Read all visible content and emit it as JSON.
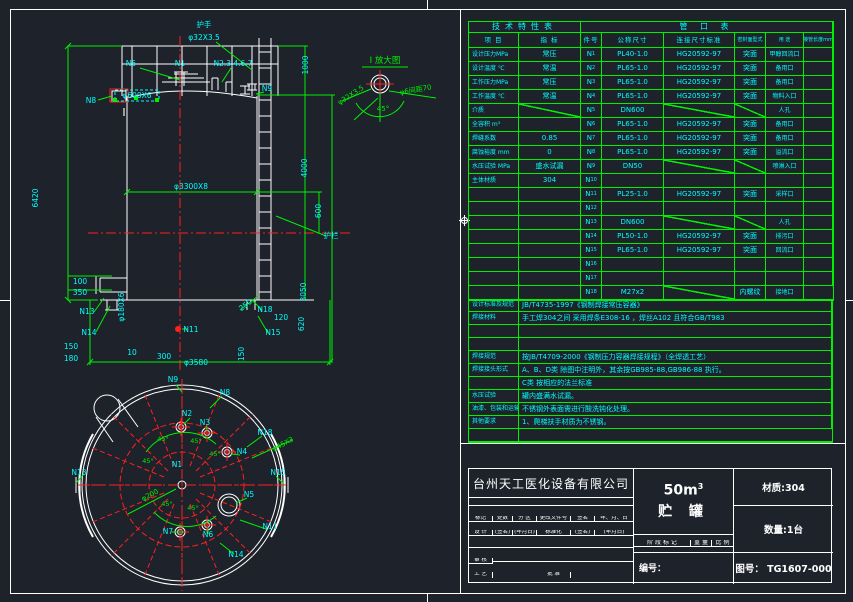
{
  "tech_table": {
    "title": "技术特性表",
    "headers": [
      "项 目",
      "指 标"
    ],
    "rows": [
      {
        "label": "设计压力MPa",
        "value": "常压"
      },
      {
        "label": "设计温度 ℃",
        "value": "常温"
      },
      {
        "label": "工作压力MPa",
        "value": "常压"
      },
      {
        "label": "工作温度 ℃",
        "value": "常温"
      },
      {
        "label": "介质",
        "value": "",
        "vd": true
      },
      {
        "label": "全容积  m³",
        "value": ""
      },
      {
        "label": "焊缝系数",
        "value": "0.85"
      },
      {
        "label": "腐蚀裕度 mm",
        "value": "0"
      },
      {
        "label": "水压试验 MPa",
        "value": "盛水试漏"
      },
      {
        "label": "主体材质",
        "value": "304"
      },
      {
        "label": "",
        "value": ""
      },
      {
        "label": "",
        "value": ""
      },
      {
        "label": "",
        "value": ""
      },
      {
        "label": "",
        "value": ""
      },
      {
        "label": "",
        "value": ""
      },
      {
        "label": "",
        "value": ""
      },
      {
        "label": "",
        "value": ""
      },
      {
        "label": "",
        "value": ""
      }
    ]
  },
  "nozzle_table": {
    "title": "管 口 表",
    "headers": [
      "件号",
      "公称尺寸",
      "连接尺寸标准",
      "密封面型式",
      "用 途",
      "接管长度mm"
    ],
    "rows": [
      {
        "no": "N1",
        "size": "PL40-1.0",
        "std": "HG20592-97",
        "face": "突面",
        "use": "甲醇回流口",
        "len": ""
      },
      {
        "no": "N2",
        "size": "PL65-1.0",
        "std": "HG20592-97",
        "face": "突面",
        "use": "备用口",
        "len": ""
      },
      {
        "no": "N3",
        "size": "PL65-1.0",
        "std": "HG20592-97",
        "face": "突面",
        "use": "备用口",
        "len": ""
      },
      {
        "no": "N4",
        "size": "PL65-1.0",
        "std": "HG20592-97",
        "face": "突面",
        "use": "物料入口",
        "len": ""
      },
      {
        "no": "N5",
        "size": "DN600",
        "std": "",
        "face": "",
        "use": "人孔",
        "len": "",
        "sd": true,
        "fd": true
      },
      {
        "no": "N6",
        "size": "PL65-1.0",
        "std": "HG20592-97",
        "face": "突面",
        "use": "备用口",
        "len": ""
      },
      {
        "no": "N7",
        "size": "PL65-1.0",
        "std": "HG20592-97",
        "face": "突面",
        "use": "备用口",
        "len": ""
      },
      {
        "no": "N8",
        "size": "PL65-1.0",
        "std": "HG20592-97",
        "face": "突面",
        "use": "溢流口",
        "len": ""
      },
      {
        "no": "N9",
        "size": "DN50",
        "std": "",
        "face": "",
        "use": "喷淋入口",
        "len": "",
        "sd": true,
        "fd": true
      },
      {
        "no": "N10",
        "size": "",
        "std": "",
        "face": "",
        "use": "",
        "len": ""
      },
      {
        "no": "N11",
        "size": "PL25-1.0",
        "std": "HG20592-97",
        "face": "突面",
        "use": "采样口",
        "len": ""
      },
      {
        "no": "N12",
        "size": "",
        "std": "",
        "face": "",
        "use": "",
        "len": ""
      },
      {
        "no": "N13",
        "size": "DN600",
        "std": "",
        "face": "",
        "use": "人孔",
        "len": "",
        "sd": true,
        "fd": true
      },
      {
        "no": "N14",
        "size": "PL50-1.0",
        "std": "HG20592-97",
        "face": "突面",
        "use": "排污口",
        "len": ""
      },
      {
        "no": "N15",
        "size": "PL65-1.0",
        "std": "HG20592-97",
        "face": "突面",
        "use": "回流口",
        "len": ""
      },
      {
        "no": "N16",
        "size": "",
        "std": "",
        "face": "",
        "use": "",
        "len": ""
      },
      {
        "no": "N17",
        "size": "",
        "std": "",
        "face": "",
        "use": "",
        "len": ""
      },
      {
        "no": "N18",
        "size": "M27x2",
        "std": "",
        "face": "内螺纹",
        "use": "接地口",
        "len": "",
        "sd": true
      }
    ]
  },
  "notes": {
    "rows": [
      {
        "label": "设计标准及规范",
        "text": "JB/T4735-1997《钢制焊接常压容器》"
      },
      {
        "label": "焊接材料",
        "text": "手工焊304之间 采用焊条E308-16 ，焊丝A102 且符合GB/T983"
      },
      {
        "label": "",
        "text": ""
      },
      {
        "label": "",
        "text": ""
      },
      {
        "label": "焊接规范",
        "text": "按JB/T4709-2000《钢制压力容器焊接规程》（全焊透工艺）"
      },
      {
        "label": "焊接接头形式",
        "text": "A、B、D类  除图中注明外，其余按GB985-88,GB986-88 执行。"
      },
      {
        "label": "",
        "text": "  C类   按相应的法兰标准"
      },
      {
        "label": "水压试验",
        "text": "罐内盛满水试漏。"
      },
      {
        "label": "油漆、包装和运输",
        "text": "不锈钢外表面需进行酸洗钝化处理。"
      },
      {
        "label": "其他要求",
        "text": "1、爬梯扶手材质为不锈钢。"
      },
      {
        "label": "",
        "text": ""
      }
    ]
  },
  "title_block": {
    "company": "台州天工医化设备有限公司",
    "capacity": "50m",
    "capacity_sup": "3",
    "product": "贮 罐",
    "material": "材质:304",
    "quantity": "数量:1台",
    "serial_label": "编号：",
    "drawing_no": "图号： TG1607-000",
    "stage": [
      "阶 段 标 记",
      "重 量",
      "比 例"
    ],
    "left_rows": [
      [
        "",
        "",
        "",
        "",
        "",
        ""
      ],
      [
        "标记",
        "处数",
        "分 区",
        "更改文件号",
        "签名",
        "年、月、日"
      ],
      [
        "设 计",
        "(签名)",
        "(年月日)",
        "标准化",
        "(签名)",
        "(年月日)"
      ],
      [
        "",
        "",
        "",
        "",
        "",
        ""
      ],
      [
        "审 核",
        "",
        "",
        "",
        "",
        ""
      ],
      [
        "工 艺",
        "",
        "",
        "批 准",
        "",
        ""
      ]
    ]
  },
  "drawing": {
    "texts": [
      {
        "n": "label-handrail",
        "x": 204,
        "y": 27,
        "t": "护手"
      },
      {
        "n": "dim-handrail-size",
        "x": 204,
        "y": 40,
        "t": "φ32X3.5"
      },
      {
        "n": "label-n5-front",
        "x": 131,
        "y": 66,
        "t": "N5"
      },
      {
        "n": "label-n1-front",
        "x": 180,
        "y": 66,
        "t": "N1"
      },
      {
        "n": "label-nozzle-group",
        "x": 233,
        "y": 66,
        "t": "N2.3.4.6.7"
      },
      {
        "n": "label-n9-front",
        "x": 267,
        "y": 91,
        "t": "N9"
      },
      {
        "n": "label-n8-front",
        "x": 91,
        "y": 103,
        "t": "N8"
      },
      {
        "n": "section-mark-I",
        "x": 124,
        "y": 116,
        "t": "Ⅰ",
        "c": "#ffffff",
        "s": 11
      },
      {
        "n": "dim-600x6-selected",
        "x": 137,
        "y": 98,
        "t": "φ600X6"
      },
      {
        "n": "dim-1000",
        "x": 308,
        "y": 65,
        "t": "1000",
        "r": -90
      },
      {
        "n": "dim-4000",
        "x": 307,
        "y": 168,
        "t": "4000",
        "r": -90
      },
      {
        "n": "dim-600",
        "x": 321,
        "y": 211,
        "t": "600",
        "r": -90
      },
      {
        "n": "label-guardrail",
        "x": 331,
        "y": 238,
        "t": "护栏"
      },
      {
        "n": "dim-shell",
        "x": 191,
        "y": 189,
        "t": "φ3300X8"
      },
      {
        "n": "dim-total-height",
        "x": 38,
        "y": 198,
        "t": "6420",
        "r": -90
      },
      {
        "n": "dim-100",
        "x": 80,
        "y": 284,
        "t": "100"
      },
      {
        "n": "dim-350",
        "x": 80,
        "y": 295,
        "t": "350"
      },
      {
        "n": "dim-180x6",
        "x": 124,
        "y": 307,
        "t": "φ180X6",
        "r": -90
      },
      {
        "n": "label-n13-front",
        "x": 87,
        "y": 314,
        "t": "N13"
      },
      {
        "n": "label-n14-front",
        "x": 89,
        "y": 335,
        "t": "N14"
      },
      {
        "n": "dim-150-left",
        "x": 71,
        "y": 349,
        "t": "150"
      },
      {
        "n": "dim-180-left",
        "x": 71,
        "y": 361,
        "t": "180"
      },
      {
        "n": "dim-10",
        "x": 132,
        "y": 355,
        "t": "10"
      },
      {
        "n": "dim-300",
        "x": 164,
        "y": 359,
        "t": "300"
      },
      {
        "n": "dim-bottom-dia",
        "x": 196,
        "y": 365,
        "t": "φ3580"
      },
      {
        "n": "label-n11-front",
        "x": 191,
        "y": 332,
        "t": "N11"
      },
      {
        "n": "dim-250",
        "x": 247,
        "y": 307,
        "t": "250",
        "r": -38
      },
      {
        "n": "label-n18-front",
        "x": 265,
        "y": 312,
        "t": "N18"
      },
      {
        "n": "dim-120",
        "x": 281,
        "y": 320,
        "t": "120"
      },
      {
        "n": "label-n15-front",
        "x": 273,
        "y": 335,
        "t": "N15"
      },
      {
        "n": "dim-620",
        "x": 304,
        "y": 324,
        "t": "620",
        "r": -90
      },
      {
        "n": "dim-3050",
        "x": 306,
        "y": 292,
        "t": "3050",
        "r": -90
      },
      {
        "n": "dim-150-right",
        "x": 244,
        "y": 354,
        "t": "150",
        "r": -90
      },
      {
        "n": "detail-title",
        "x": 385,
        "y": 63,
        "t": "Ⅰ 放大图",
        "c": "#00f000",
        "s": 8.5
      },
      {
        "n": "detail-dim-pipe",
        "x": 352,
        "y": 97,
        "t": "φ32X3.5",
        "r": -33,
        "c": "#00f000",
        "s": 7
      },
      {
        "n": "detail-dim-rod",
        "x": 416,
        "y": 92,
        "t": "φ6间距70",
        "r": -10,
        "c": "#00f000",
        "s": 7
      },
      {
        "n": "detail-angle",
        "x": 383,
        "y": 111,
        "t": "45°",
        "c": "#00f000",
        "s": 7
      },
      {
        "n": "label-n9-plan",
        "x": 173,
        "y": 382,
        "t": "N9"
      },
      {
        "n": "label-n8-plan",
        "x": 225,
        "y": 395,
        "t": "N8"
      },
      {
        "n": "label-n2-plan",
        "x": 187,
        "y": 416,
        "t": "N2"
      },
      {
        "n": "label-n3-plan",
        "x": 205,
        "y": 425,
        "t": "N3"
      },
      {
        "n": "label-n18-plan",
        "x": 265,
        "y": 435,
        "t": "N18"
      },
      {
        "n": "label-n4-plan",
        "x": 242,
        "y": 454,
        "t": "N4"
      },
      {
        "n": "dim-45x3",
        "x": 284,
        "y": 446,
        "t": "φ45X3",
        "r": -28,
        "c": "#00f000",
        "s": 7
      },
      {
        "n": "label-n13-plan",
        "x": 79,
        "y": 475,
        "t": "N13"
      },
      {
        "n": "label-n15-plan",
        "x": 278,
        "y": 475,
        "t": "N15"
      },
      {
        "n": "label-n1-plan",
        "x": 177,
        "y": 467,
        "t": "N1"
      },
      {
        "n": "label-n5-plan",
        "x": 249,
        "y": 497,
        "t": "N5"
      },
      {
        "n": "label-n11-plan",
        "x": 270,
        "y": 529,
        "t": "N11"
      },
      {
        "n": "label-n7-plan",
        "x": 168,
        "y": 534,
        "t": "N7"
      },
      {
        "n": "label-n6-plan",
        "x": 208,
        "y": 537,
        "t": "N6"
      },
      {
        "n": "label-n14-plan",
        "x": 236,
        "y": 557,
        "t": "N14"
      },
      {
        "n": "dim-200",
        "x": 151,
        "y": 497,
        "t": "φ200",
        "r": -28,
        "c": "#00f000",
        "s": 7
      },
      {
        "n": "angle-45-a",
        "x": 163,
        "y": 441,
        "t": "45°",
        "c": "#00f000",
        "s": 6.5
      },
      {
        "n": "angle-45-b",
        "x": 196,
        "y": 443,
        "t": "45°",
        "c": "#00f000",
        "s": 6.5
      },
      {
        "n": "angle-45-c",
        "x": 215,
        "y": 456,
        "t": "45°",
        "c": "#00f000",
        "s": 6.5
      },
      {
        "n": "angle-45-d",
        "x": 167,
        "y": 506,
        "t": "45°",
        "c": "#00f000",
        "s": 6.5
      },
      {
        "n": "angle-45-e",
        "x": 193,
        "y": 510,
        "t": "45°",
        "c": "#00f000",
        "s": 6.5
      },
      {
        "n": "angle-45-f",
        "x": 148,
        "y": 463,
        "t": "45°",
        "c": "#00f000",
        "s": 6.5
      }
    ]
  }
}
